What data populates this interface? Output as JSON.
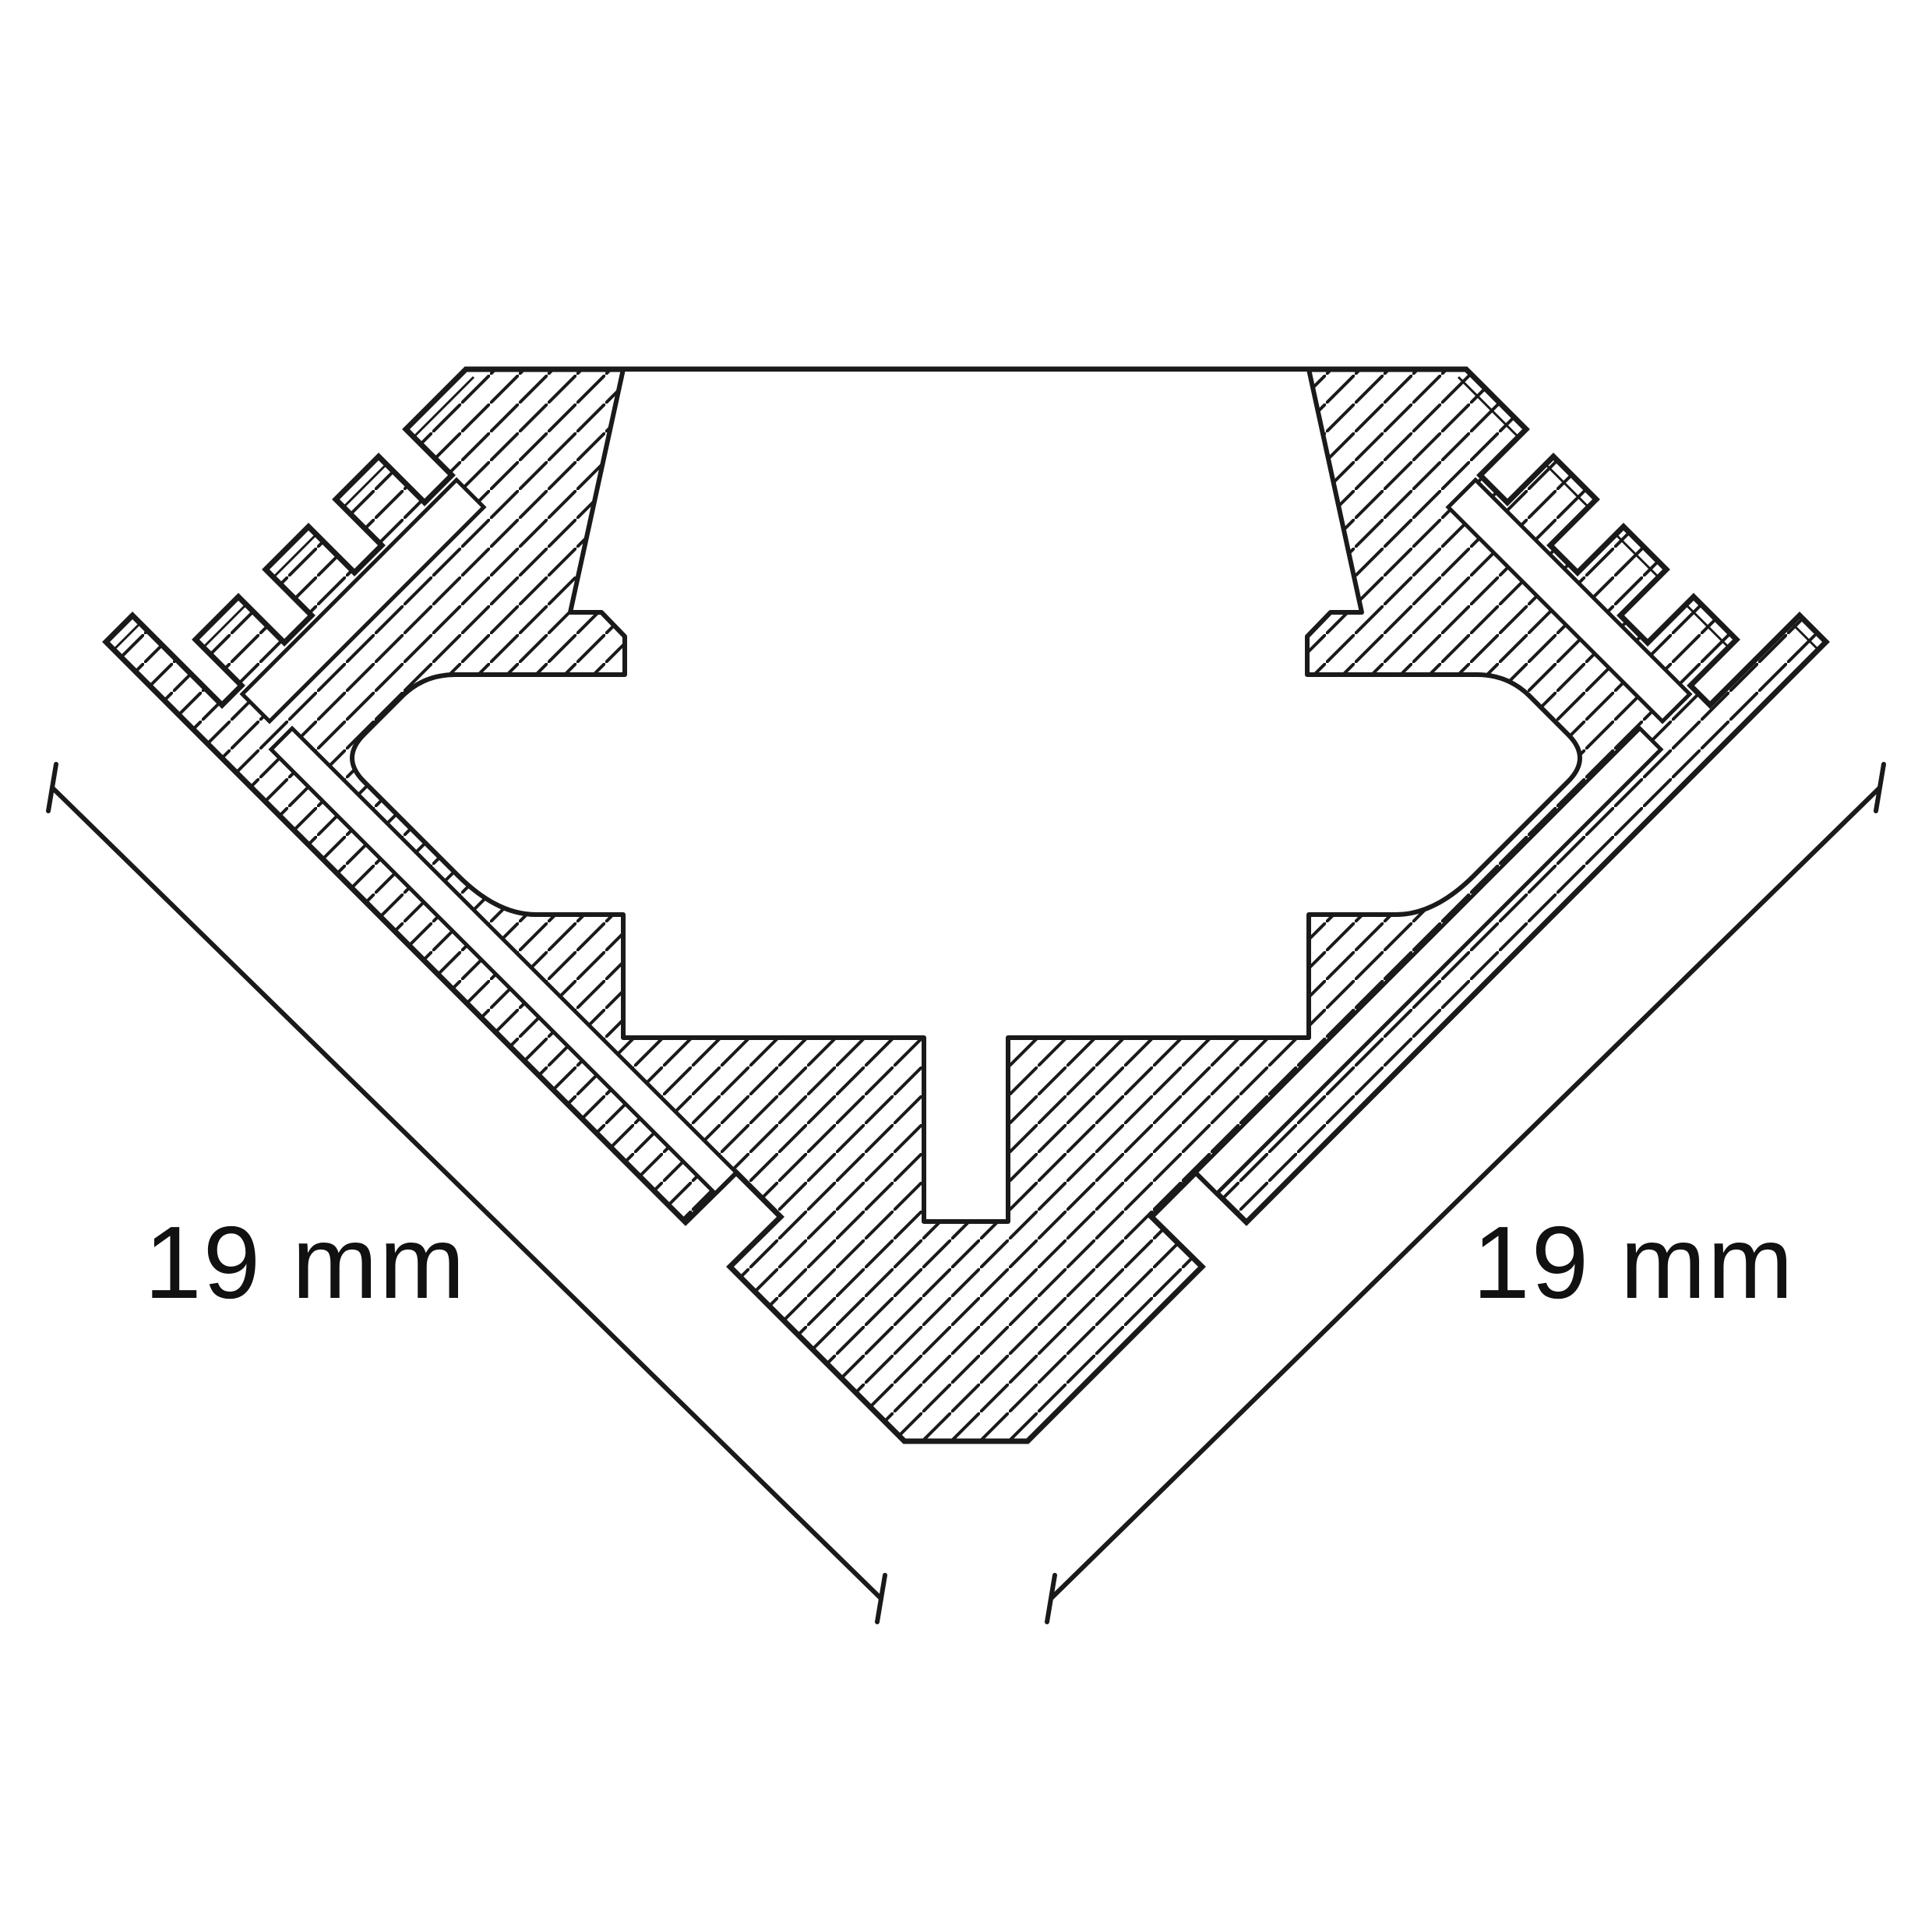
{
  "drawing": {
    "type_note": "profile-cross-section",
    "dimension_left": {
      "label": "19 mm"
    },
    "dimension_right": {
      "label": "19 mm"
    },
    "colors": {
      "background": "#ffffff",
      "line": "#1a1a1a",
      "text": "#111111"
    }
  }
}
